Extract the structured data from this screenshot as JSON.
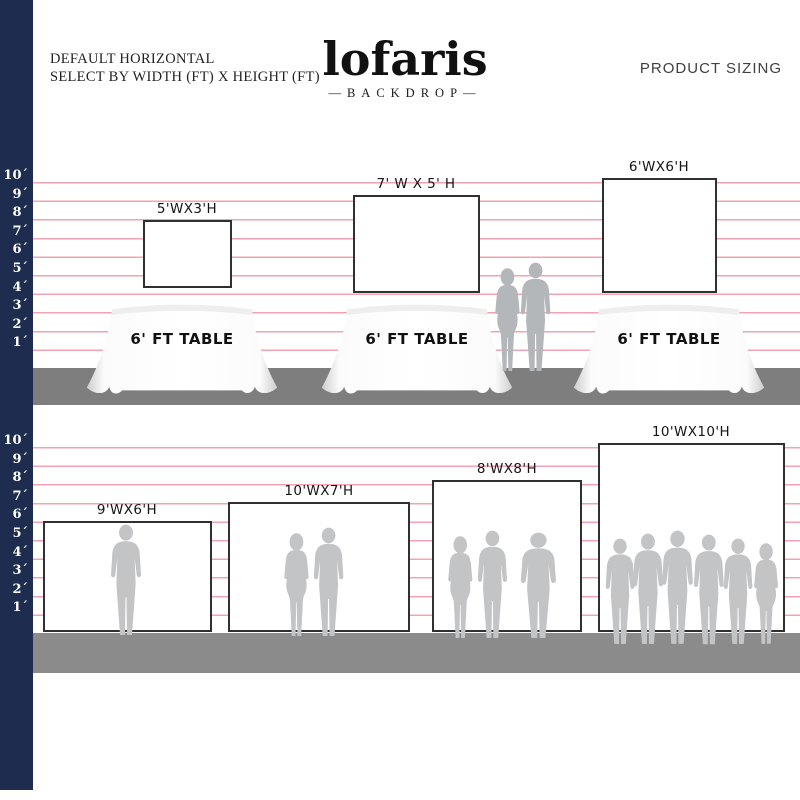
{
  "header": {
    "subtitle_line1": "DEFAULT HORIZONTAL",
    "subtitle_line2": "SELECT BY WIDTH (FT) X HEIGHT (FT)",
    "logo_text": "lofaris",
    "logo_tagline": "—BACKDROP—",
    "right_title": "PRODUCT SIZING"
  },
  "ruler": {
    "unit": "feet",
    "labels": [
      "10´",
      "9´",
      "8´",
      "7´",
      "6´",
      "5´",
      "4´",
      "3´",
      "2´",
      "1´"
    ]
  },
  "colors": {
    "navy_bar": "#1e2d4f",
    "grid_line_pink": "#f2a3b3",
    "ground_upper": "#7e7e7e",
    "ground_lower": "#8b8b8b",
    "silhouette_upper": "#b4b7ba",
    "silhouette_lower": "#c3c4c6",
    "backdrop_border": "#303030"
  },
  "sections": [
    {
      "name": "backdrops-over-tables",
      "backdrops": [
        {
          "label": "5'WX3'H",
          "width_ft": 5,
          "height_ft": 3,
          "table_label": "6' FT TABLE"
        },
        {
          "label": "7' W X 5' H",
          "width_ft": 7,
          "height_ft": 5,
          "table_label": "6' FT TABLE"
        },
        {
          "label": "6'WX6'H",
          "width_ft": 6,
          "height_ft": 6,
          "table_label": "6' FT TABLE"
        }
      ],
      "people_between_tables": 2
    },
    {
      "name": "backdrops-with-people",
      "backdrops": [
        {
          "label": "9'WX6'H",
          "width_ft": 9,
          "height_ft": 6,
          "people": 1
        },
        {
          "label": "10'WX7'H",
          "width_ft": 10,
          "height_ft": 7,
          "people": 2
        },
        {
          "label": "8'WX8'H",
          "width_ft": 8,
          "height_ft": 8,
          "people": 3
        },
        {
          "label": "10'WX10'H",
          "width_ft": 10,
          "height_ft": 10,
          "people": 6
        }
      ]
    }
  ]
}
